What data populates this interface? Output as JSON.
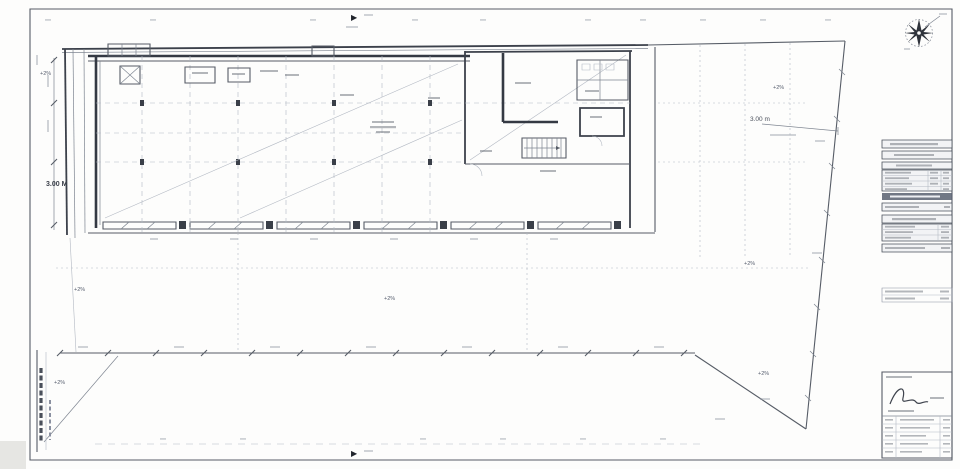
{
  "labels": {
    "setback_left": "3.00 M",
    "setback_right": "3.00 m",
    "slope_mark": "+2%",
    "section_marker": "▶"
  },
  "compass": {
    "icon": "north-compass-rose"
  },
  "colors": {
    "paper": "#fdfdfc",
    "ink_dark": "#343943",
    "ink_medium": "#6a7078",
    "ink_faint": "#b3b9c3"
  }
}
